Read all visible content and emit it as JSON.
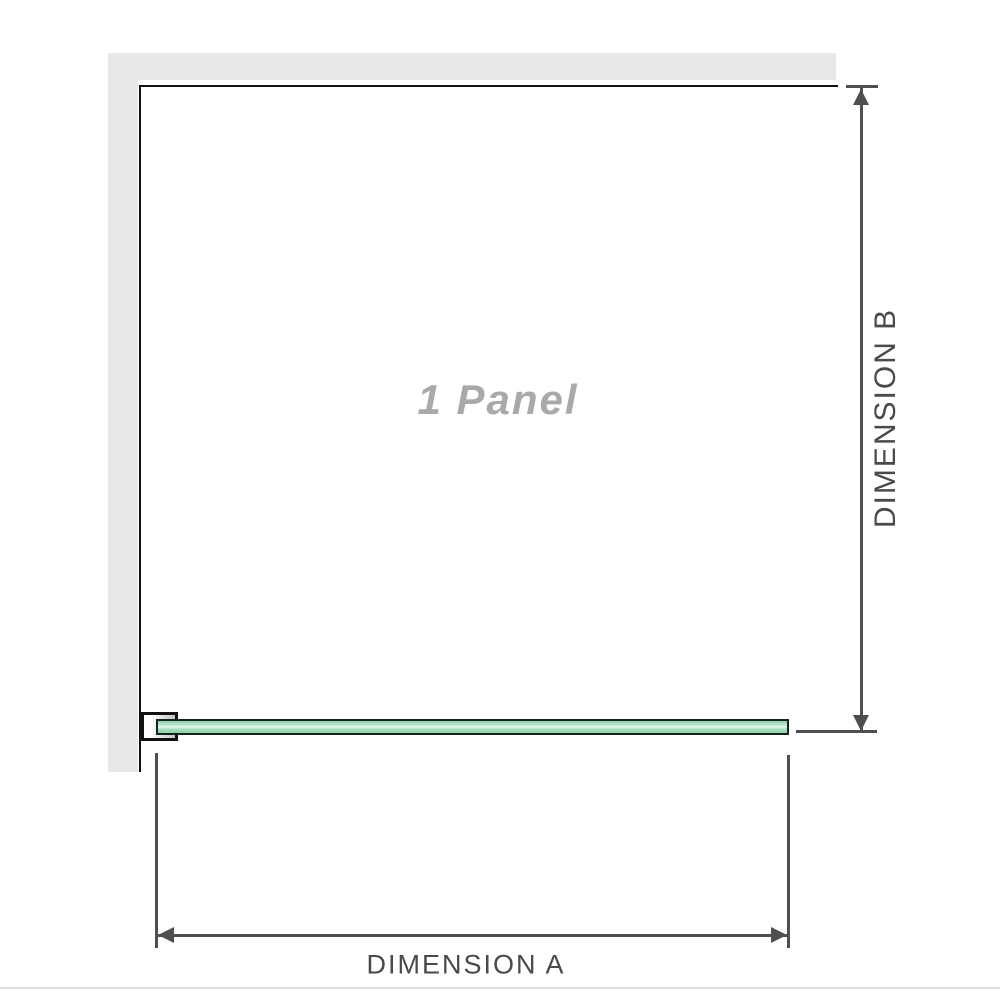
{
  "diagram": {
    "panel_label": "1 Panel",
    "dimension_a": {
      "label": "DIMENSION A"
    },
    "dimension_b": {
      "label": "DIMENSION B"
    },
    "colors": {
      "wall": "#e8e8e8",
      "outline": "#111111",
      "glass_border": "#16251c",
      "glass_fill_light": "#e9f8f0",
      "glass_fill": "#8fd0ac",
      "dimension_line": "#4f4f4f",
      "dimension_text": "#4a4a4a",
      "watermark_text": "#a9a9a9",
      "footer_rule": "#e0ded8"
    }
  }
}
